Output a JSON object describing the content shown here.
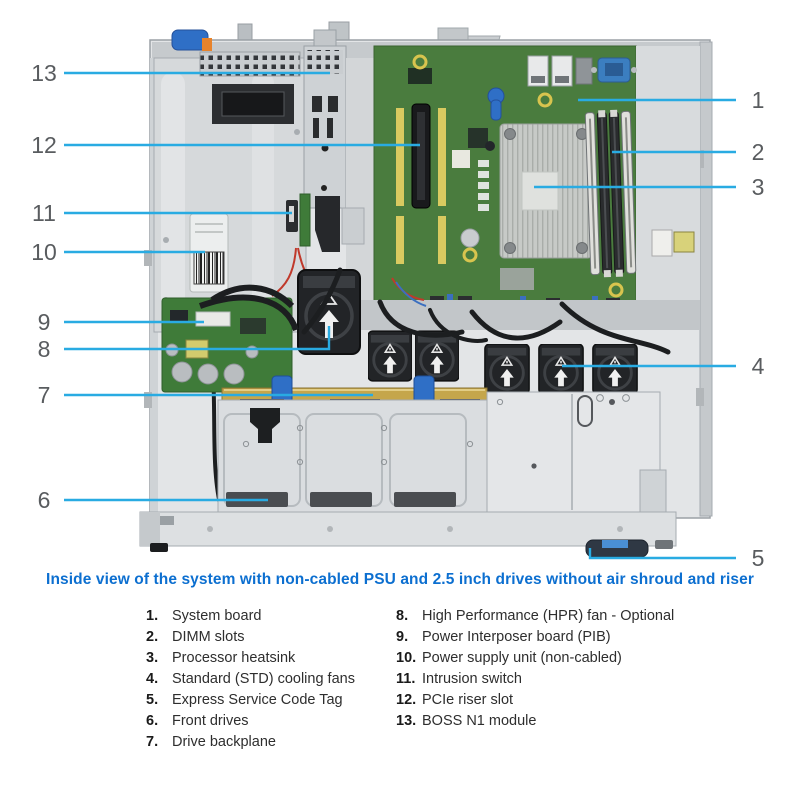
{
  "figure": {
    "description": "Top-down inside view of a 1U rack server chassis",
    "callout_line_color": "#29ABE2",
    "callout_number_color": "#595C5F",
    "callouts": [
      {
        "num": "1",
        "target": "system-board"
      },
      {
        "num": "2",
        "target": "dimm-slots"
      },
      {
        "num": "3",
        "target": "processor-heatsink"
      },
      {
        "num": "4",
        "target": "standard-cooling-fans"
      },
      {
        "num": "5",
        "target": "express-service-code-tag"
      },
      {
        "num": "6",
        "target": "front-drives"
      },
      {
        "num": "7",
        "target": "drive-backplane"
      },
      {
        "num": "8",
        "target": "hpr-fan"
      },
      {
        "num": "9",
        "target": "power-interposer-board"
      },
      {
        "num": "10",
        "target": "power-supply-unit"
      },
      {
        "num": "11",
        "target": "intrusion-switch"
      },
      {
        "num": "12",
        "target": "pcie-riser-slot"
      },
      {
        "num": "13",
        "target": "boss-n1-module"
      }
    ]
  },
  "caption": "Inside view of the system with non-cabled PSU and 2.5 inch drives without air shroud and riser",
  "legend": {
    "left": [
      {
        "num": "1.",
        "label": "System board"
      },
      {
        "num": "2.",
        "label": "DIMM slots"
      },
      {
        "num": "3.",
        "label": "Processor heatsink"
      },
      {
        "num": "4.",
        "label": "Standard (STD) cooling fans"
      },
      {
        "num": "5.",
        "label": "Express Service Code Tag"
      },
      {
        "num": "6.",
        "label": "Front drives"
      },
      {
        "num": "7.",
        "label": "Drive backplane"
      }
    ],
    "right": [
      {
        "num": "8.",
        "label": "High Performance (HPR) fan - Optional"
      },
      {
        "num": "9.",
        "label": "Power Interposer board (PIB)"
      },
      {
        "num": "10.",
        "label": "Power supply unit (non-cabled)"
      },
      {
        "num": "11.",
        "label": "Intrusion switch"
      },
      {
        "num": "12.",
        "label": "PCIe riser slot"
      },
      {
        "num": "13.",
        "label": "BOSS N1 module"
      }
    ]
  },
  "colors": {
    "caption_blue": "#0C6FD0",
    "leader_blue": "#29ABE2",
    "board_green": "#4A7C3E",
    "chassis_gray": "#E3E5E7",
    "backplane_gold": "#C5A64B",
    "latch_blue": "#2F6FC6"
  }
}
